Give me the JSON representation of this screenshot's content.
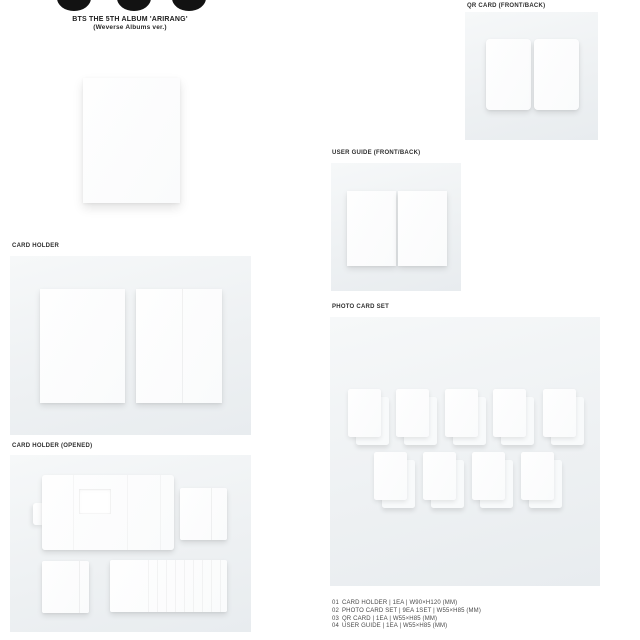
{
  "brand": {
    "logo": "three-dots-logo",
    "title": "BTS THE 5TH ALBUM 'ARIRANG'",
    "subtitle": "(Weverse Albums ver.)"
  },
  "sections": {
    "card_holder": {
      "label": "CARD HOLDER"
    },
    "card_holder_opened": {
      "label": "CARD HOLDER (OPENED)"
    },
    "qr_card": {
      "label": "QR CARD (FRONT/BACK)"
    },
    "user_guide": {
      "label": "USER GUIDE (FRONT/BACK)"
    },
    "photo_card_set": {
      "label": "PHOTO CARD SET",
      "card_count": 9
    }
  },
  "spec_list": [
    {
      "num": "01",
      "text": "CARD HOLDER | 1EA | W90×H120 (MM)"
    },
    {
      "num": "02",
      "text": "PHOTO CARD SET | 9EA 1SET | W55×H85 (MM)"
    },
    {
      "num": "03",
      "text": "QR CARD | 1EA | W55×H85 (MM)"
    },
    {
      "num": "04",
      "text": "USER GUIDE | 1EA | W55×H85 (MM)"
    }
  ],
  "colors": {
    "page_bg": "#ffffff",
    "panel_top": "#f6f8f9",
    "panel_bottom": "#e8ecef",
    "product_white": "#fdfdfe",
    "logo_black": "#121212",
    "label_text": "#2e2e2e",
    "spec_text": "#4a4a4a"
  }
}
